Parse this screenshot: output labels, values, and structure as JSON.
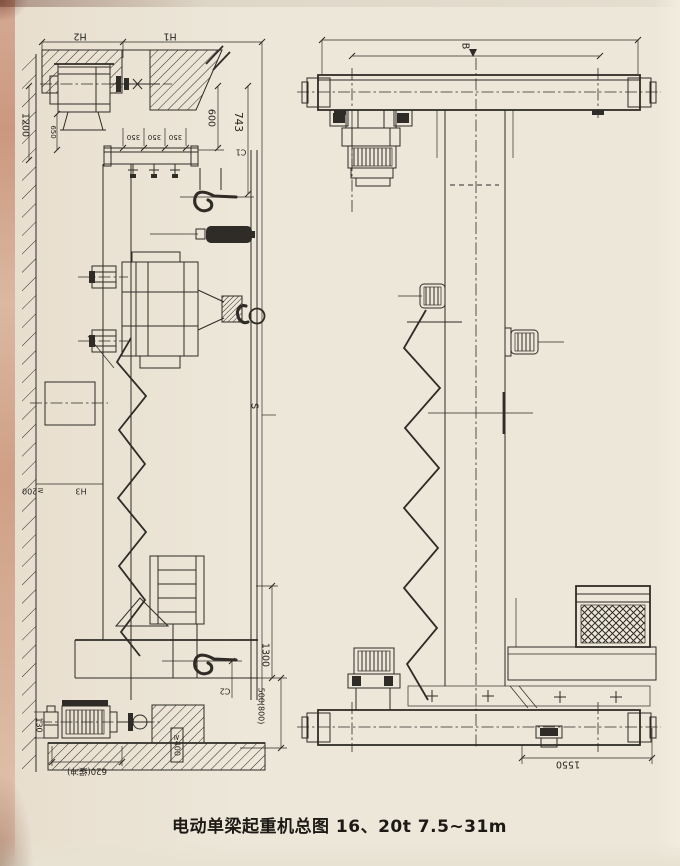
{
  "drawing": {
    "caption": "电动单梁起重机总图 16、20t 7.5~31m",
    "colors": {
      "paper": "#ece7d9",
      "ink": "#2f2b26",
      "edge_tint": "#c8886f"
    },
    "side_view": {
      "dims": {
        "h2": "H2",
        "h1": "H1",
        "v1200": "1200",
        "v650": "650",
        "s350_1": "350",
        "s350_2": "350",
        "s350_3": "350",
        "v600": "600",
        "v743": "743",
        "c1": "C1",
        "span": "S",
        "h3": "H3",
        "ge200": "≥200",
        "v130": "130",
        "v620": "620(缓冲)",
        "ge400": "≥400",
        "c2": "C2",
        "v1300": "1300",
        "v500_800": "500(800)"
      }
    },
    "end_view": {
      "dims": {
        "b": "B",
        "v1550": "1550"
      }
    }
  }
}
